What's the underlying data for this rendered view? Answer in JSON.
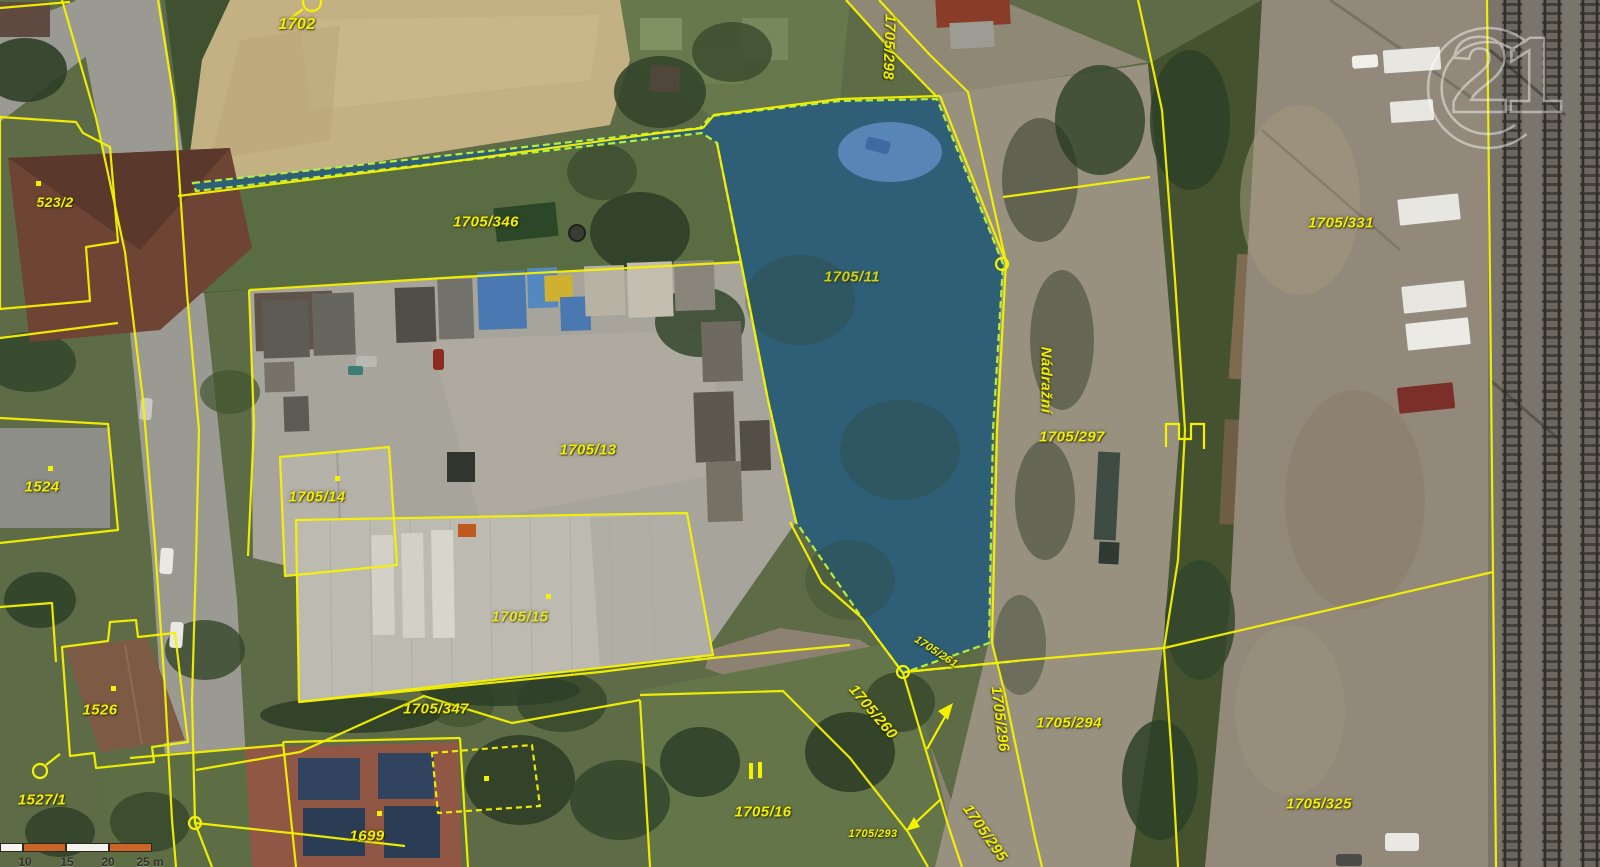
{
  "map": {
    "type": "cadastral-aerial-map",
    "selected_parcel": "1705/11",
    "street_name": "Nádražní",
    "colors": {
      "parcel_line": "#f5f200",
      "parcel_label": "#f2ee00",
      "highlight_fill": "#2369b9",
      "highlight_outline": "#b2f03e",
      "scalebar_orange": "#c96527",
      "scalebar_white": "#f5f3ee"
    },
    "labels": [
      {
        "text": "1702",
        "x": 297,
        "y": 25,
        "rot": 0,
        "size": 16
      },
      {
        "text": "523/2",
        "x": 55,
        "y": 202,
        "rot": 0,
        "size": 14
      },
      {
        "text": "1705/346",
        "x": 486,
        "y": 222,
        "rot": 0,
        "size": 15
      },
      {
        "text": "1705/298",
        "x": 889,
        "y": 47,
        "rot": 92,
        "size": 15
      },
      {
        "text": "1705/11",
        "x": 852,
        "y": 277,
        "rot": 0,
        "size": 15,
        "dim": true
      },
      {
        "text": "Nádražní",
        "x": 1046,
        "y": 380,
        "rot": 90,
        "size": 15,
        "street": true
      },
      {
        "text": "1705/297",
        "x": 1072,
        "y": 437,
        "rot": 0,
        "size": 15
      },
      {
        "text": "1705/331",
        "x": 1341,
        "y": 223,
        "rot": 0,
        "size": 15
      },
      {
        "text": "1524",
        "x": 42,
        "y": 487,
        "rot": 0,
        "size": 15
      },
      {
        "text": "1705/13",
        "x": 588,
        "y": 450,
        "rot": 0,
        "size": 15
      },
      {
        "text": "1705/14",
        "x": 317,
        "y": 497,
        "rot": 0,
        "size": 15
      },
      {
        "text": "1705/15",
        "x": 520,
        "y": 617,
        "rot": 0,
        "size": 15,
        "dim": true
      },
      {
        "text": "1705/347",
        "x": 436,
        "y": 709,
        "rot": 0,
        "size": 15
      },
      {
        "text": "1526",
        "x": 100,
        "y": 710,
        "rot": 0,
        "size": 15
      },
      {
        "text": "1527/1",
        "x": 42,
        "y": 800,
        "rot": 0,
        "size": 15
      },
      {
        "text": "1699",
        "x": 367,
        "y": 836,
        "rot": 0,
        "size": 15
      },
      {
        "text": "1705/16",
        "x": 763,
        "y": 812,
        "rot": 0,
        "size": 15
      },
      {
        "text": "1705/260",
        "x": 873,
        "y": 712,
        "rot": 50,
        "size": 15
      },
      {
        "text": "1705/261",
        "x": 936,
        "y": 652,
        "rot": 33,
        "size": 11
      },
      {
        "text": "1705/296",
        "x": 1000,
        "y": 719,
        "rot": 83,
        "size": 15
      },
      {
        "text": "1705/293",
        "x": 873,
        "y": 834,
        "rot": 0,
        "size": 11
      },
      {
        "text": "1705/295",
        "x": 985,
        "y": 833,
        "rot": 55,
        "size": 15
      },
      {
        "text": "1705/294",
        "x": 1069,
        "y": 723,
        "rot": 0,
        "size": 15
      },
      {
        "text": "1705/325",
        "x": 1319,
        "y": 804,
        "rot": 0,
        "size": 15
      }
    ]
  },
  "scale_bar": {
    "segments": [
      {
        "w": 23,
        "color": "#f5f3ee"
      },
      {
        "w": 43,
        "color": "#c96527"
      },
      {
        "w": 43,
        "color": "#f5f3ee"
      },
      {
        "w": 43,
        "color": "#c96527"
      }
    ],
    "labels": [
      {
        "text": "10",
        "x": 25
      },
      {
        "text": "15",
        "x": 67
      },
      {
        "text": "20",
        "x": 108
      },
      {
        "text": "25 m",
        "x": 150
      }
    ]
  },
  "watermark": {
    "text": "21"
  }
}
